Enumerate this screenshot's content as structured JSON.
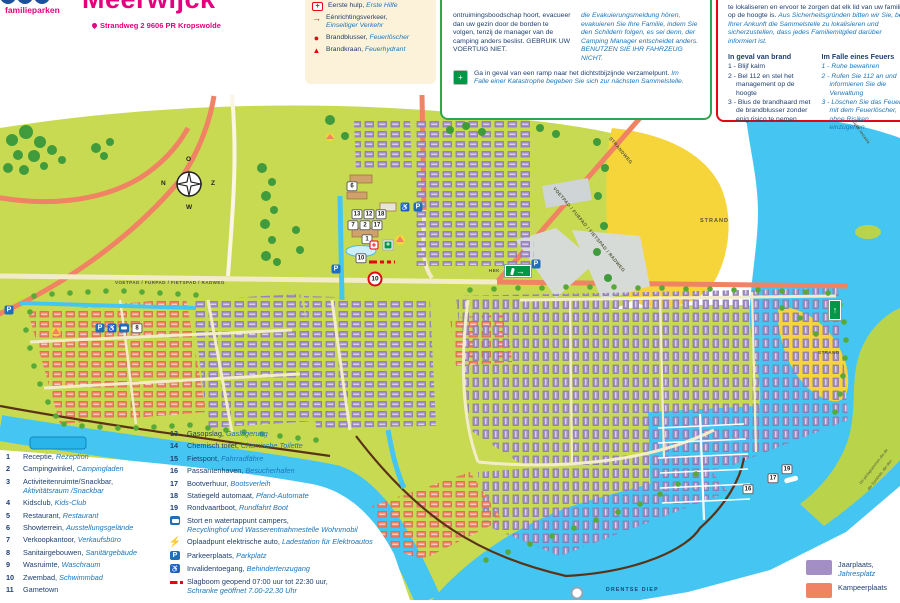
{
  "header": {
    "brand": "familieparken",
    "title": "Meerwijck",
    "address": "Strandweg 2 9606 PR Kropswolde"
  },
  "safety_legend": {
    "items": [
      {
        "icon": "defibrillator-icon",
        "nl": "Defibrillator,",
        "de": "Defibrilator"
      },
      {
        "icon": "first-aid-icon",
        "nl": "Eerste hulp,",
        "de": "Erste Hilfe"
      },
      {
        "icon": "one-way-icon",
        "nl": "Eénrichtingsverkeer,",
        "de": "Einseitiger Verkehr"
      },
      {
        "icon": "fire-extinguisher-icon",
        "nl": "Brandblusser,",
        "de": "Feuerlöscher"
      },
      {
        "icon": "fire-hydrant-icon",
        "nl": "Brandkraan,",
        "de": "Feuerhydrant"
      }
    ]
  },
  "evacuation_box": {
    "nl": "ontruimingsboodschap hoort, evacueer dan uw gezin door de borden te volgen, tenzij de manager van de camping anders beslist. GEBRUIK UW VOERTUIG NIET.",
    "de": "die Evakuierungsmeldung hören, evakuieren Sie Ihre Familie, indem Sie den Schildern folgen, es sei denn, der Camping Manager entscheidet anders. BENUTZEN SIE IHR FAHRZEUG NICHT.",
    "note_nl": "Ga in geval van een ramp naar het dichtstbijzijnde verzamelpunt.",
    "note_de": "Im Falle einer Katastrophe begeben Sie sich zur nächsten Sammelstelle."
  },
  "fire_box": {
    "intro_nl": "te lokaliseren en ervoor te zorgen dat elk lid van uw familie op de hoogte is.",
    "intro_de": "Aus Sicherheitsgründen bitten wir Sie, bei Ihrer Ankunft die Sammelstelle zu lokalisieren und sicherzustellen, dass jedes Familiemitglied darüber informiert ist.",
    "nl_title": "In geval van brand",
    "nl_items": [
      "1 - Blijf kalm",
      "2 - Bel 112 en stel het management op de hoogte",
      "3 - Blus de brandhaard met de brandblusser zonder enig risico te nemen."
    ],
    "de_title": "Im Falle eines Feuers",
    "de_items": [
      "1 - Ruhe bewahren",
      "2 - Rufen Sie 112 an und informieren Sie die Verwaltung",
      "3 - Löschen Sie das Feuer mit dem Feuerlöscher, ohne Risiken einzugehen."
    ]
  },
  "poi_left": [
    {
      "num": "1",
      "nl": "Receptie,",
      "de": "Rezeption"
    },
    {
      "num": "2",
      "nl": "Campingwinkel,",
      "de": "Campingladen"
    },
    {
      "num": "3",
      "nl": "Activiteitenruimte/Snackbar,",
      "de": "Aktivitätsraum /Snackbar"
    },
    {
      "num": "4",
      "nl": "Kidsclub,",
      "de": "Kids-Club"
    },
    {
      "num": "5",
      "nl": "Restaurant,",
      "de": "Restaurant"
    },
    {
      "num": "6",
      "nl": "Showterrein,",
      "de": "Ausstellungsgelände"
    },
    {
      "num": "7",
      "nl": "Verkoopkantoor,",
      "de": "Verkaufsbüro"
    },
    {
      "num": "8",
      "nl": "Sanitairgebouwen,",
      "de": "Sanitärgebäude"
    },
    {
      "num": "9",
      "nl": "Wasruimte,",
      "de": "Waschraum"
    },
    {
      "num": "10",
      "nl": "Zwembad,",
      "de": "Schwimmbad"
    },
    {
      "num": "11",
      "nl": "Gametown",
      "de": ""
    }
  ],
  "poi_mid": [
    {
      "num": "13",
      "nl": "Gasopslag,",
      "de": "Gaslagerung"
    },
    {
      "num": "14",
      "nl": "Chemisch toilet,",
      "de": "Chemische Toilette"
    },
    {
      "num": "15",
      "nl": "Fietspont,",
      "de": "Fahrradfähre"
    },
    {
      "num": "16",
      "nl": "Passantenhaven,",
      "de": "Besucherhafen"
    },
    {
      "num": "17",
      "nl": "Bootverhuur,",
      "de": "Bootsverleih"
    },
    {
      "num": "18",
      "nl": "Statiegeld automaat,",
      "de": "Pfand-Automate"
    },
    {
      "num": "19",
      "nl": "Rondvaartboot,",
      "de": "Rundfahrt Boot"
    }
  ],
  "poi_icons": [
    {
      "icon": "camper-service-icon",
      "nl": "Stort en watertappunt campers,",
      "de": "Recyclinghof und Wasserentnahmestelle Wohnmobil"
    },
    {
      "icon": "ev-charger-icon",
      "nl": "Oplaadpunt elektrische auto,",
      "de": "Ladestation für Elektroautos"
    },
    {
      "icon": "parking-icon",
      "nl": "Parkeerplaats,",
      "de": "Parkplatz"
    },
    {
      "icon": "wheelchair-icon",
      "nl": "Invalidentoegang,",
      "de": "Behindertenzugang"
    },
    {
      "icon": "barrier-icon",
      "nl": "Slagboom geopend 07:00 uur tot 22:30 uur,",
      "de": "Schranke geöffnet 7.00-22.30 Uhr"
    }
  ],
  "area_legend": [
    {
      "swatch": "#a38fc5",
      "nl": "Jaarplaats,",
      "de": "Jahresplatz"
    },
    {
      "swatch": "#ef8364",
      "nl": "Kampeerplaats",
      "de": ""
    }
  ],
  "map": {
    "labels": {
      "voetpad_h": "VOETPAD / FURPAD / FIETSPAD / RADWEG",
      "strandweg": "STRANDWEG",
      "voetpad_diag": "VOETPAD / FUßPAD / FIETSPAD / RADWEG",
      "strand1": "STRAND",
      "strand2": "STRAND",
      "hek": "HEK",
      "drentse_diep": "DRENTSE DIEP",
      "shore_note_nl": "De pictogrammen die de",
      "shore_note_de": "die Symbole, die den",
      "shore_note_top": "lijke locatie"
    },
    "compass": {
      "top": "O",
      "left": "N",
      "right": "Z",
      "bottom": "W"
    },
    "markers": [
      {
        "t": "num",
        "x": 352,
        "y": 186,
        "l": "6"
      },
      {
        "t": "num",
        "x": 357,
        "y": 214,
        "l": "13"
      },
      {
        "t": "num",
        "x": 369,
        "y": 214,
        "l": "12"
      },
      {
        "t": "num",
        "x": 381,
        "y": 214,
        "l": "18"
      },
      {
        "t": "num",
        "x": 353,
        "y": 225,
        "l": "7"
      },
      {
        "t": "num",
        "x": 365,
        "y": 225,
        "l": "2"
      },
      {
        "t": "num",
        "x": 377,
        "y": 225,
        "l": "17"
      },
      {
        "t": "num",
        "x": 367,
        "y": 239,
        "l": "1"
      },
      {
        "t": "num",
        "x": 361,
        "y": 258,
        "l": "10"
      },
      {
        "t": "num",
        "x": 137,
        "y": 328,
        "l": "8"
      },
      {
        "t": "num",
        "x": 748,
        "y": 489,
        "l": "16"
      },
      {
        "t": "num",
        "x": 773,
        "y": 478,
        "l": "17"
      },
      {
        "t": "num",
        "x": 787,
        "y": 469,
        "l": "19"
      },
      {
        "t": "parking",
        "x": 9,
        "y": 310,
        "l": "P"
      },
      {
        "t": "parking",
        "x": 100,
        "y": 328,
        "l": "P"
      },
      {
        "t": "parking",
        "x": 336,
        "y": 269,
        "l": "P"
      },
      {
        "t": "parking",
        "x": 418,
        "y": 207,
        "l": "P"
      },
      {
        "t": "parking",
        "x": 536,
        "y": 264,
        "l": "P"
      },
      {
        "t": "wheelchair",
        "x": 112,
        "y": 328,
        "l": "♿"
      },
      {
        "t": "wheelchair",
        "x": 405,
        "y": 207,
        "l": "♿"
      },
      {
        "t": "camper",
        "x": 124,
        "y": 328,
        "l": ""
      },
      {
        "t": "cross",
        "x": 374,
        "y": 245,
        "l": "+"
      },
      {
        "t": "assembly",
        "x": 388,
        "y": 245,
        "l": "+"
      },
      {
        "t": "speed",
        "x": 375,
        "y": 279,
        "l": "10"
      },
      {
        "t": "exit",
        "x": 518,
        "y": 271,
        "l": "→"
      },
      {
        "t": "exitup",
        "x": 835,
        "y": 310,
        "l": "↑"
      },
      {
        "t": "barrier",
        "x": 382,
        "y": 262,
        "l": ""
      },
      {
        "t": "pin",
        "x": 577,
        "y": 593,
        "l": ""
      }
    ]
  }
}
